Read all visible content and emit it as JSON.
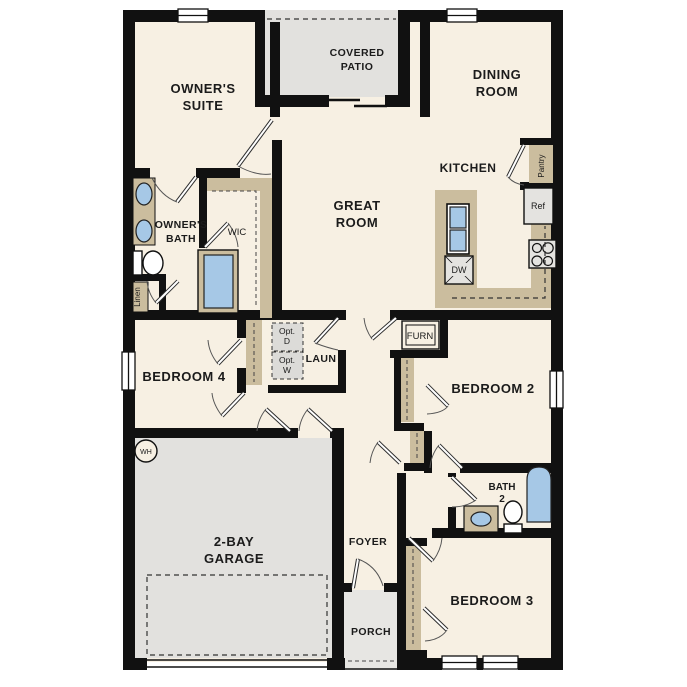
{
  "palette": {
    "wall": "#111111",
    "floor": "#f7f0e3",
    "patio_garage_grey": "#e2e1de",
    "porch_grey": "#e7e6e3",
    "cabinet_tan": "#cbbd9e",
    "fixture_blue": "#a6c8e6",
    "appliance_grey": "#e4e3e0"
  },
  "rooms": {
    "owners_suite": {
      "lines": [
        "OWNER'S",
        "SUITE"
      ]
    },
    "covered_patio": {
      "lines": [
        "COVERED",
        "PATIO"
      ]
    },
    "dining_room": {
      "lines": [
        "DINING",
        "ROOM"
      ]
    },
    "great_room": {
      "lines": [
        "GREAT",
        "ROOM"
      ]
    },
    "kitchen": {
      "lines": [
        "KITCHEN"
      ]
    },
    "owners_bath": {
      "lines": [
        "OWNER'S",
        "BATH"
      ]
    },
    "wic": {
      "lines": [
        "WIC"
      ]
    },
    "bedroom4": {
      "lines": [
        "BEDROOM 4"
      ]
    },
    "laundry": {
      "lines": [
        "LAUN"
      ]
    },
    "bedroom2": {
      "lines": [
        "BEDROOM 2"
      ]
    },
    "garage": {
      "lines": [
        "2-BAY",
        "GARAGE"
      ]
    },
    "foyer": {
      "lines": [
        "FOYER"
      ]
    },
    "porch": {
      "lines": [
        "PORCH"
      ]
    },
    "bath2": {
      "lines": [
        "BATH",
        "2"
      ]
    },
    "bedroom3": {
      "lines": [
        "BEDROOM 3"
      ]
    }
  },
  "fixtures": {
    "pantry": "Pantry",
    "refrigerator": "Ref",
    "dishwasher": "DW",
    "linen": "Linen",
    "furnace": "FURN",
    "water_heater": "WH",
    "opt_dryer": {
      "lines": [
        "Opt.",
        "D"
      ]
    },
    "opt_washer": {
      "lines": [
        "Opt.",
        "W"
      ]
    }
  }
}
